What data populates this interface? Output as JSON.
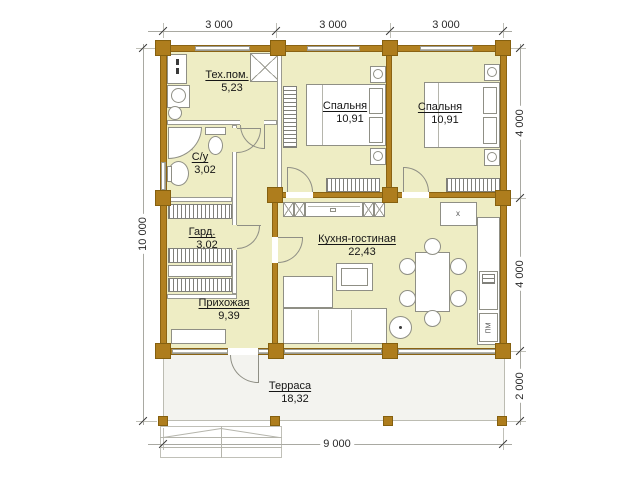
{
  "plan": {
    "rooms": {
      "tech": {
        "name": "Тех.пом.",
        "area": "5,23"
      },
      "bathroom": {
        "name": "С/у",
        "area": "3,02"
      },
      "wardrobe": {
        "name": "Гард.",
        "area": "3,02"
      },
      "hallway": {
        "name": "Прихожая",
        "area": "9,39"
      },
      "bedroom1": {
        "name": "Спальня",
        "area": "10,91"
      },
      "bedroom2": {
        "name": "Спальня",
        "area": "10,91"
      },
      "kitchen": {
        "name": "Кухня-гостиная",
        "area": "22,43"
      },
      "terrace": {
        "name": "Терраса",
        "area": "18,32"
      }
    },
    "dimensions": {
      "top": [
        "3 000",
        "3 000",
        "3 000"
      ],
      "right": [
        "4 000",
        "4 000",
        "2 000"
      ],
      "left": "10 000",
      "bottom": "9 000"
    },
    "kitchen_marks": {
      "stove_mark": "x",
      "dishwasher_label": "ПМ"
    },
    "colors": {
      "wall": "#b28121",
      "room_fill": "#eeedc4",
      "terrace_fill": "#f3f3ef"
    }
  }
}
